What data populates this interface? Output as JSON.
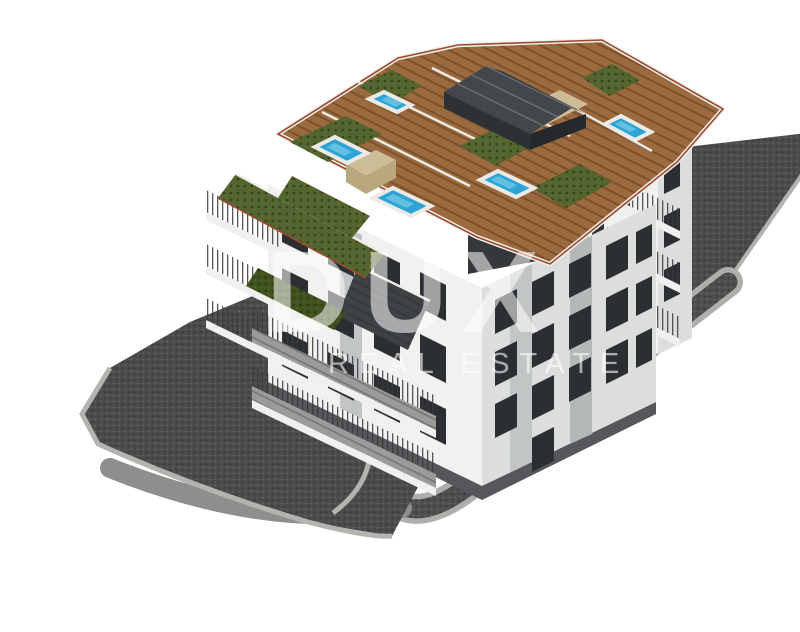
{
  "watermark": {
    "brand": "DUX",
    "tagline": "REAL ESTATE"
  },
  "scene": {
    "description": "Aerial 3D architectural rendering of a modern white multi-storey residential building with rooftop wooden deck terraces, five blue plunge pools, green roof gardens, a dark gabled roof structure, stacked balconies, dark gravel terrain and a curved access ramp with a hairpin turn.",
    "pool_count": 5,
    "building_type": "residential apartment building",
    "view": "aerial isometric"
  },
  "palette": {
    "background": "#ffffff",
    "facade": "#f1f1ef",
    "facade_shade": "#dcdedd",
    "window": "#2c2f31",
    "wood_deck": "#9b6a3e",
    "wood_slat": "#7c5027",
    "roof_garden": "#55652f",
    "pool_water": "#2ea4d6",
    "pool_light": "#7fd0ea",
    "stone_beige": "#cdbd97",
    "railing_red": "#9c4a2f",
    "terrain_dark": "#4b4b4b",
    "road_gray": "#8e8e8c",
    "wall_light": "#b5b3ae",
    "pergola_dark": "#34373b",
    "watermark_white": "#ffffff"
  }
}
